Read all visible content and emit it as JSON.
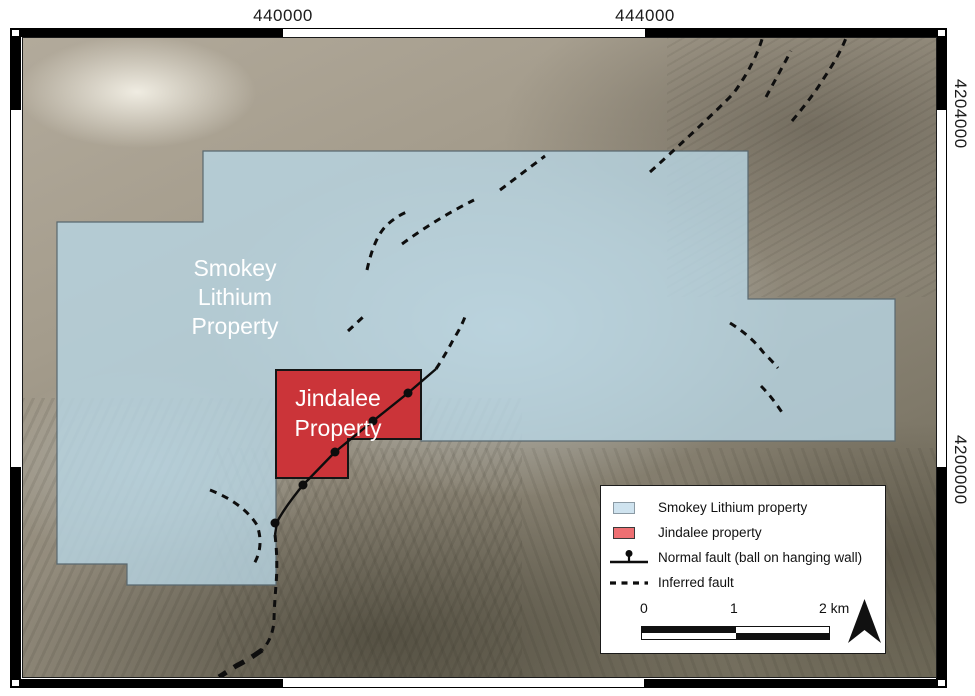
{
  "axes": {
    "top": [
      "440000",
      "444000"
    ],
    "right": [
      "4204000",
      "4200000"
    ]
  },
  "map_labels": {
    "smokey": [
      "Smokey",
      "Lithium",
      "Property"
    ],
    "jindalee": [
      "Jindalee",
      "Property"
    ]
  },
  "legend": {
    "items": [
      {
        "label": "Smokey Lithium property",
        "swatch": "#cfe3ef"
      },
      {
        "label": "Jindalee property",
        "swatch": "#ee6f72"
      },
      {
        "label": "Normal fault (ball on hanging wall)",
        "symbol": "normal-fault"
      },
      {
        "label": "Inferred fault",
        "symbol": "inferred-fault"
      }
    ],
    "scale_bar": {
      "labels": [
        "0",
        "1",
        "2 km"
      ]
    }
  },
  "colors": {
    "smokey_property_fill": "#b7d4e2",
    "jindalee_property_fill": "#cb3439",
    "fault": "#111111",
    "terrain_base": "#8f8879"
  }
}
